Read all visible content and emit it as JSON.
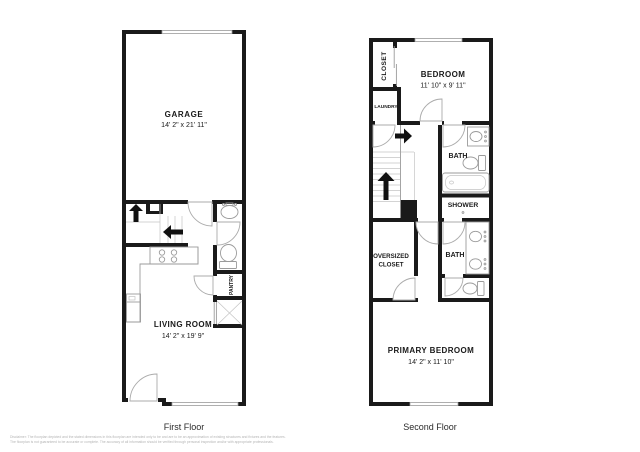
{
  "colors": {
    "background": "#ffffff",
    "wall": "#1a1a1a",
    "fixture_outline": "#9b9b9b",
    "label_text": "#1a1a1a",
    "caption_text": "#2b2b2b",
    "disclaimer_text": "#b5b5b5"
  },
  "first_floor": {
    "caption": "First Floor",
    "garage": {
      "name": "GARAGE",
      "dims": "14' 2\" x 21' 11\""
    },
    "living_room": {
      "name": "LIVING ROOM",
      "dims": "14' 2\" x 19' 9\""
    },
    "pantry": {
      "name": "PANTRY"
    }
  },
  "second_floor": {
    "caption": "Second Floor",
    "bedroom": {
      "name": "BEDROOM",
      "dims": "11' 10\" x 9' 11\""
    },
    "closet": {
      "name": "CLOSET"
    },
    "laundry": {
      "name": "LAUNDRY"
    },
    "bath_upper": {
      "name": "BATH"
    },
    "shower": {
      "name": "SHOWER"
    },
    "oversized_closet": {
      "line1": "OVERSIZED",
      "line2": "CLOSET"
    },
    "bath_lower": {
      "name": "BATH"
    },
    "primary_bedroom": {
      "name": "PRIMARY BEDROOM",
      "dims": "14' 2\" x 11' 10\""
    }
  },
  "footer": {
    "disclaimer_line1": "Disclaimer: The floorplan depicted and the stated dimensions in this floorplan are intended only to be and are to be an approximation of existing structures and fixtures and the features.",
    "disclaimer_line2": "The floorplan is not guaranteed to be accurate or complete. The accuracy of all information should be verified through personal inspection and/or with appropriate professionals."
  }
}
